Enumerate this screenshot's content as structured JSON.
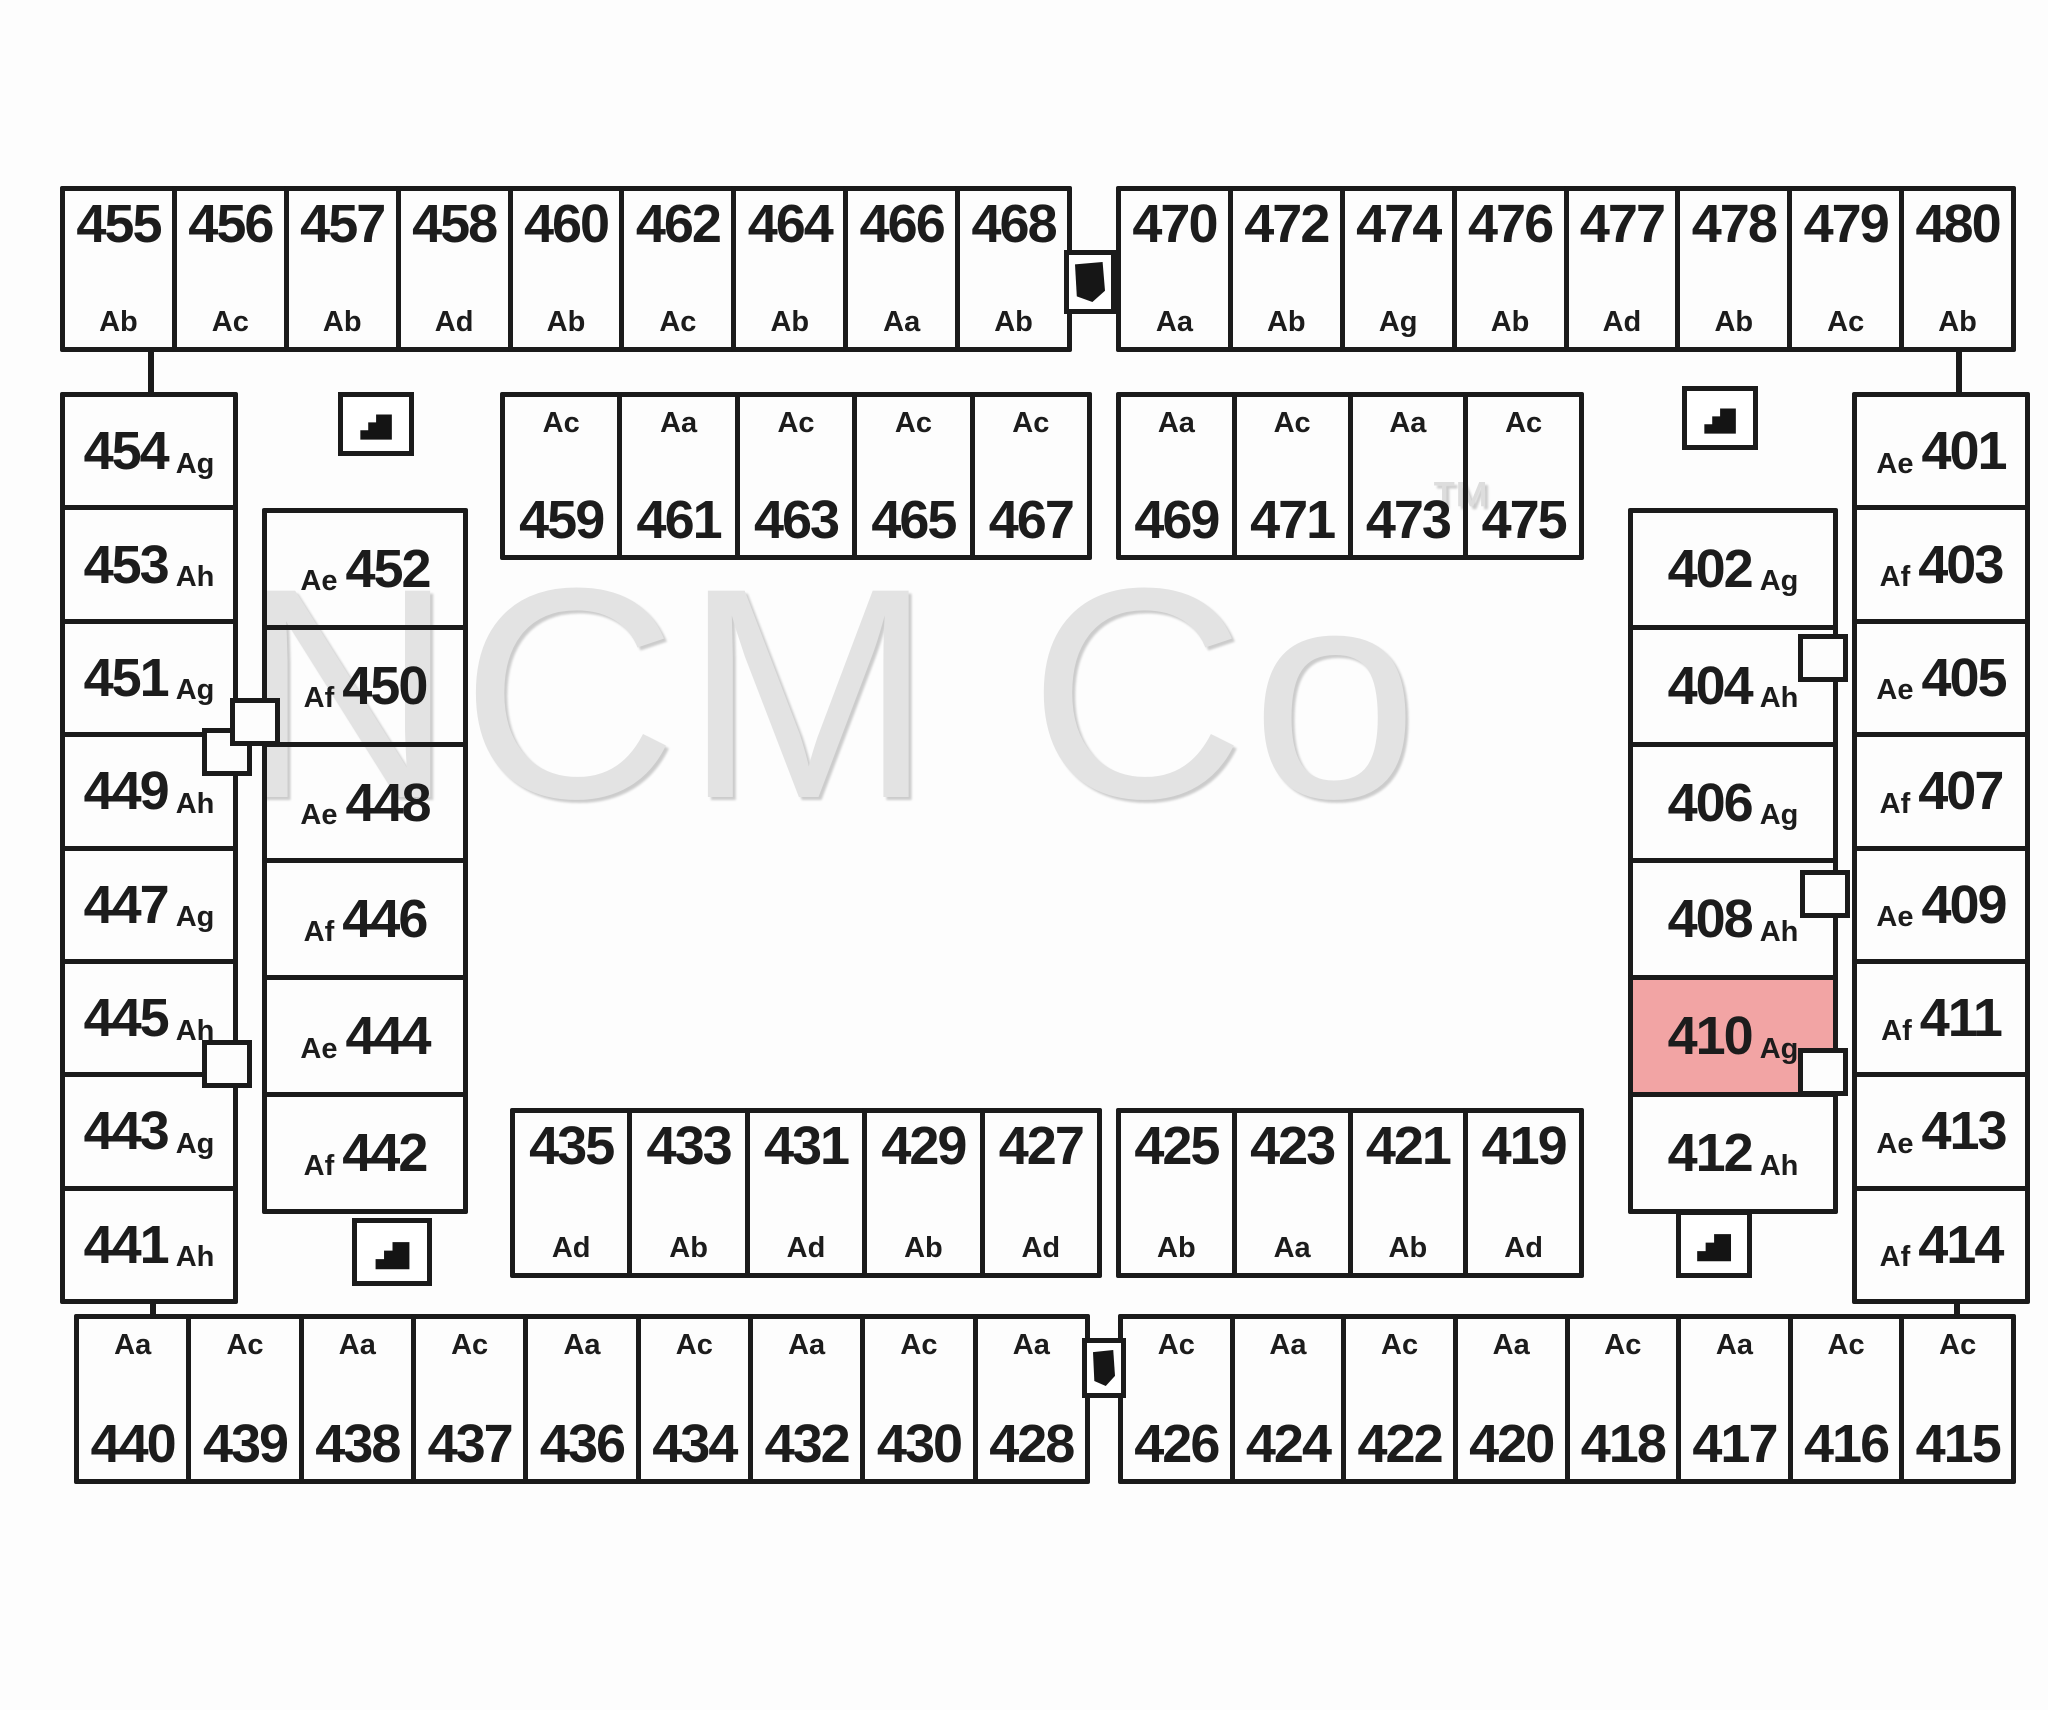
{
  "watermark": {
    "text": "NCM Co",
    "tm": "™"
  },
  "colors": {
    "line": "#1b1b1b",
    "highlight": "#f2a4a4",
    "watermark": "#e3e3e3",
    "background": "#fdfdfd"
  },
  "icons": {
    "stairs": "stairs-icon",
    "connector": "breezeway-connector-icon"
  },
  "plan": {
    "groups": [
      {
        "id": "top-outer-left",
        "layout": "num-top",
        "units": [
          {
            "num": "455",
            "type": "Ab"
          },
          {
            "num": "456",
            "type": "Ac"
          },
          {
            "num": "457",
            "type": "Ab"
          },
          {
            "num": "458",
            "type": "Ad"
          },
          {
            "num": "460",
            "type": "Ab"
          },
          {
            "num": "462",
            "type": "Ac"
          },
          {
            "num": "464",
            "type": "Ab"
          },
          {
            "num": "466",
            "type": "Aa"
          },
          {
            "num": "468",
            "type": "Ab"
          }
        ]
      },
      {
        "id": "top-outer-right",
        "layout": "num-top",
        "units": [
          {
            "num": "470",
            "type": "Aa"
          },
          {
            "num": "472",
            "type": "Ab"
          },
          {
            "num": "474",
            "type": "Ag"
          },
          {
            "num": "476",
            "type": "Ab"
          },
          {
            "num": "477",
            "type": "Ad"
          },
          {
            "num": "478",
            "type": "Ab"
          },
          {
            "num": "479",
            "type": "Ac"
          },
          {
            "num": "480",
            "type": "Ab"
          }
        ]
      },
      {
        "id": "top-inner-left",
        "layout": "type-top",
        "units": [
          {
            "num": "459",
            "type": "Ac"
          },
          {
            "num": "461",
            "type": "Aa"
          },
          {
            "num": "463",
            "type": "Ac"
          },
          {
            "num": "465",
            "type": "Ac"
          },
          {
            "num": "467",
            "type": "Ac"
          }
        ]
      },
      {
        "id": "top-inner-right",
        "layout": "type-top",
        "units": [
          {
            "num": "469",
            "type": "Aa"
          },
          {
            "num": "471",
            "type": "Ac"
          },
          {
            "num": "473",
            "type": "Aa"
          },
          {
            "num": "475",
            "type": "Ac"
          }
        ]
      },
      {
        "id": "left-outer",
        "layout": "num-inline",
        "units": [
          {
            "num": "454",
            "type": "Ag"
          },
          {
            "num": "453",
            "type": "Ah"
          },
          {
            "num": "451",
            "type": "Ag"
          },
          {
            "num": "449",
            "type": "Ah"
          },
          {
            "num": "447",
            "type": "Ag"
          },
          {
            "num": "445",
            "type": "Ah"
          },
          {
            "num": "443",
            "type": "Ag"
          },
          {
            "num": "441",
            "type": "Ah"
          }
        ]
      },
      {
        "id": "left-inner",
        "layout": "type-inline",
        "units": [
          {
            "num": "452",
            "type": "Ae"
          },
          {
            "num": "450",
            "type": "Af"
          },
          {
            "num": "448",
            "type": "Ae"
          },
          {
            "num": "446",
            "type": "Af"
          },
          {
            "num": "444",
            "type": "Ae"
          },
          {
            "num": "442",
            "type": "Af"
          }
        ]
      },
      {
        "id": "right-outer",
        "layout": "type-inline",
        "units": [
          {
            "num": "401",
            "type": "Ae"
          },
          {
            "num": "403",
            "type": "Af"
          },
          {
            "num": "405",
            "type": "Ae"
          },
          {
            "num": "407",
            "type": "Af"
          },
          {
            "num": "409",
            "type": "Ae"
          },
          {
            "num": "411",
            "type": "Af"
          },
          {
            "num": "413",
            "type": "Ae"
          },
          {
            "num": "414",
            "type": "Af"
          }
        ]
      },
      {
        "id": "right-inner",
        "layout": "num-inline",
        "units": [
          {
            "num": "402",
            "type": "Ag"
          },
          {
            "num": "404",
            "type": "Ah"
          },
          {
            "num": "406",
            "type": "Ag"
          },
          {
            "num": "408",
            "type": "Ah"
          },
          {
            "num": "410",
            "type": "Ag",
            "highlight": true
          },
          {
            "num": "412",
            "type": "Ah"
          }
        ]
      },
      {
        "id": "bottom-inner-left",
        "layout": "num-top",
        "units": [
          {
            "num": "435",
            "type": "Ad"
          },
          {
            "num": "433",
            "type": "Ab"
          },
          {
            "num": "431",
            "type": "Ad"
          },
          {
            "num": "429",
            "type": "Ab"
          },
          {
            "num": "427",
            "type": "Ad"
          }
        ]
      },
      {
        "id": "bottom-inner-right",
        "layout": "num-top",
        "units": [
          {
            "num": "425",
            "type": "Ab"
          },
          {
            "num": "423",
            "type": "Aa"
          },
          {
            "num": "421",
            "type": "Ab"
          },
          {
            "num": "419",
            "type": "Ad"
          }
        ]
      },
      {
        "id": "bottom-outer-left",
        "layout": "type-top",
        "units": [
          {
            "num": "440",
            "type": "Aa"
          },
          {
            "num": "439",
            "type": "Ac"
          },
          {
            "num": "438",
            "type": "Aa"
          },
          {
            "num": "437",
            "type": "Ac"
          },
          {
            "num": "436",
            "type": "Aa"
          },
          {
            "num": "434",
            "type": "Ac"
          },
          {
            "num": "432",
            "type": "Aa"
          },
          {
            "num": "430",
            "type": "Ac"
          },
          {
            "num": "428",
            "type": "Aa"
          }
        ]
      },
      {
        "id": "bottom-outer-right",
        "layout": "type-top",
        "units": [
          {
            "num": "426",
            "type": "Ac"
          },
          {
            "num": "424",
            "type": "Aa"
          },
          {
            "num": "422",
            "type": "Ac"
          },
          {
            "num": "420",
            "type": "Aa"
          },
          {
            "num": "418",
            "type": "Ac"
          },
          {
            "num": "417",
            "type": "Aa"
          },
          {
            "num": "416",
            "type": "Ac"
          },
          {
            "num": "415",
            "type": "Ac"
          }
        ]
      }
    ]
  }
}
